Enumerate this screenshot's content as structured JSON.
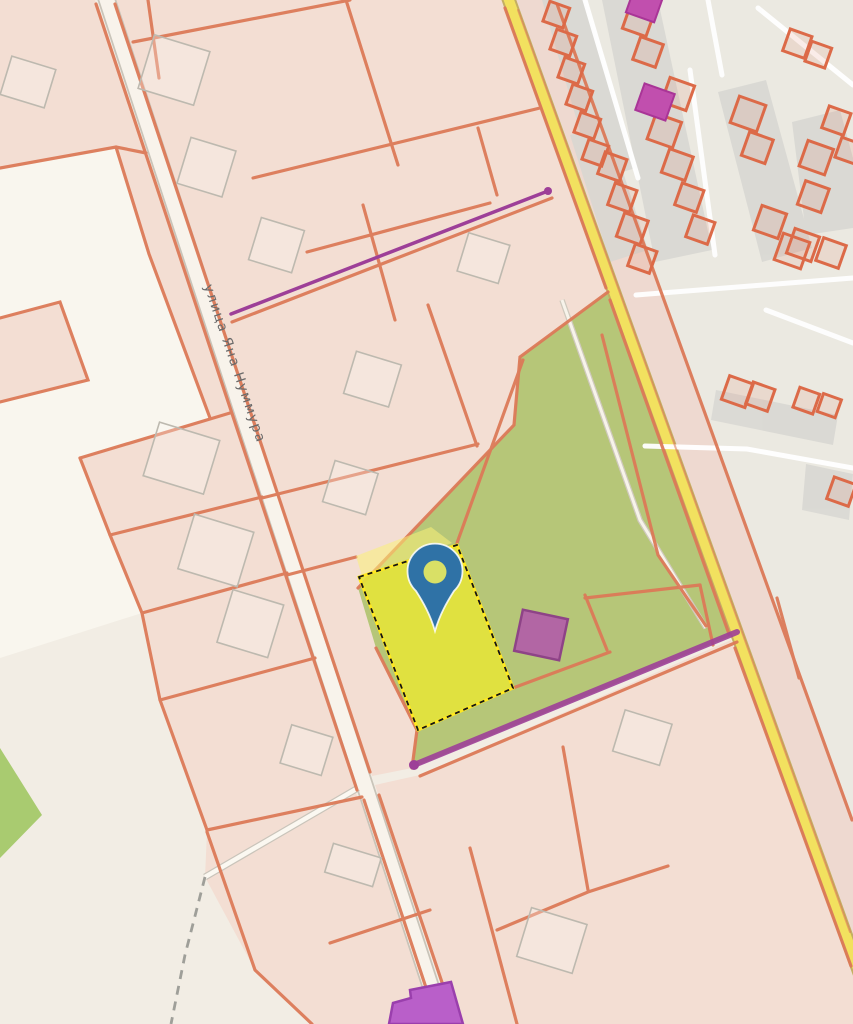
{
  "map": {
    "street_label": "улица Яна Нуммура",
    "marker": {
      "shape": "location-pin"
    },
    "selection": {
      "style": "yellow-dashed-parcel"
    }
  },
  "colors": {
    "background": "#f2ede4",
    "parcel_pink": "#f3ded3",
    "parcel_white": "#f9f6ee",
    "boundary_orange": "#dc7a58",
    "greenery": "#b6c678",
    "greenery_bright": "#a9cb70",
    "road_fill": "#f8f3eb",
    "road_yellow": "#f2e15f",
    "strip_gray": "#d8d7d2",
    "selection_yellow": "#e4e33c",
    "selection_outline": "#ffe81f",
    "marker_blue": "#2f72a6",
    "marker_hole": "#d9e066",
    "powerline_purple": "#9d3f98",
    "building_magenta": "#c14fae",
    "building_purple": "#b95fc9",
    "building_mauve": "#b266a4"
  }
}
